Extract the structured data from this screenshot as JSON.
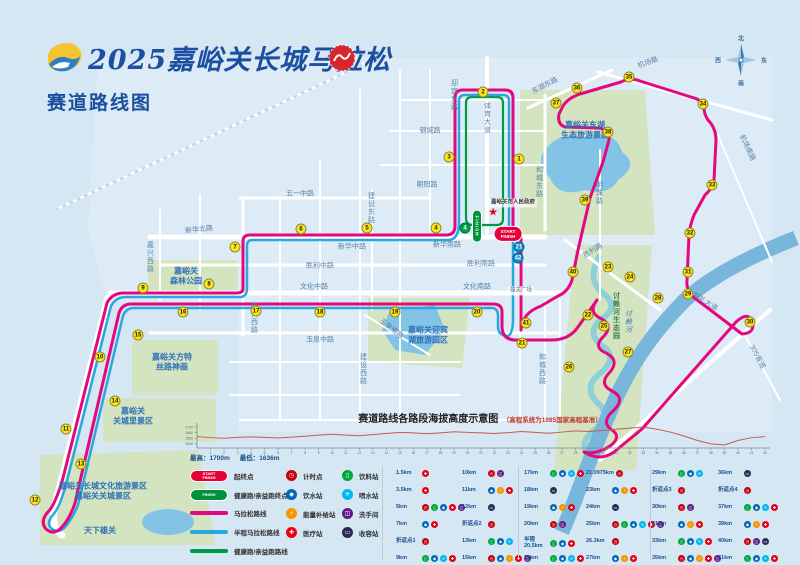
{
  "header": {
    "title": "2025嘉峪关长城马拉松",
    "subtitle": "赛道路线图",
    "icons": {
      "event_logo": "event-logo",
      "organizer_seal": "organizer-seal"
    }
  },
  "colors": {
    "marathon": "#e5077e",
    "half": "#29a8e0",
    "health": "#009a44",
    "badge_yellow": "#ffe41a",
    "start_red": "#e60039",
    "finish_green": "#00913a"
  },
  "map": {
    "compass": {
      "n": "北",
      "e": "东",
      "s": "南",
      "w": "西"
    },
    "start_badge": "START\nFINISH",
    "finish_badge": "FINISH",
    "gov_star_icon": "star-icon",
    "streets": [
      {
        "t": "机场路",
        "x": 648,
        "y": 63,
        "r": -20
      },
      {
        "t": "东湖东路",
        "x": 545,
        "y": 86,
        "r": -27
      },
      {
        "t": "机场南路",
        "x": 747,
        "y": 148,
        "r": 65
      },
      {
        "t": "体育大道",
        "x": 487,
        "y": 118,
        "v": 1
      },
      {
        "t": "迎宾东路",
        "x": 454,
        "y": 95,
        "v": 1
      },
      {
        "t": "钢城路",
        "x": 430,
        "y": 131
      },
      {
        "t": "朝阳路",
        "x": 427,
        "y": 185
      },
      {
        "t": "建设东路",
        "x": 371,
        "y": 208,
        "v": 1
      },
      {
        "t": "五一中路",
        "x": 300,
        "y": 194
      },
      {
        "t": "新华北路",
        "x": 199,
        "y": 230,
        "r": -6
      },
      {
        "t": "新华中路",
        "x": 352,
        "y": 247
      },
      {
        "t": "新华南路",
        "x": 447,
        "y": 245
      },
      {
        "t": "胜利中路",
        "x": 320,
        "y": 266
      },
      {
        "t": "胜利南路",
        "x": 481,
        "y": 264
      },
      {
        "t": "文化中路",
        "x": 314,
        "y": 287
      },
      {
        "t": "文化南路",
        "x": 477,
        "y": 287
      },
      {
        "t": "玉泉中路",
        "x": 320,
        "y": 340
      },
      {
        "t": "玉泉南路",
        "x": 391,
        "y": 329,
        "r": 38
      },
      {
        "t": "建设西路",
        "x": 363,
        "y": 369,
        "v": 1
      },
      {
        "t": "嘉兴西路",
        "x": 150,
        "y": 257,
        "v": 1
      },
      {
        "t": "雄关西路",
        "x": 254,
        "y": 318,
        "v": 1
      },
      {
        "t": "和城东路",
        "x": 539,
        "y": 182,
        "v": 1
      },
      {
        "t": "和城西路",
        "x": 542,
        "y": 369,
        "v": 1
      },
      {
        "t": "明珠路",
        "x": 599,
        "y": 193,
        "v": 1
      },
      {
        "t": "胜利路",
        "x": 593,
        "y": 251,
        "r": -33
      },
      {
        "t": "明礼大道",
        "x": 705,
        "y": 302,
        "r": 32
      },
      {
        "t": "305省道",
        "x": 757,
        "y": 357,
        "r": 62
      },
      {
        "t": "讨赖河",
        "x": 628,
        "y": 322,
        "v": 1,
        "w": 1
      }
    ],
    "landmarks": [
      {
        "t": "嘉峪关东湖\n生态旅游景区",
        "x": 585,
        "y": 131
      },
      {
        "t": "嘉峪关\n森林公园",
        "x": 186,
        "y": 277
      },
      {
        "t": "嘉峪关迎宾\n湖旅游园区",
        "x": 428,
        "y": 336
      },
      {
        "t": "嘉峪关方特\n丝路神画",
        "x": 172,
        "y": 363
      },
      {
        "t": "嘉峪关\n关城里景区",
        "x": 133,
        "y": 417
      },
      {
        "t": "嘉峪关长城文化旅游景区\n嘉峪关关城景区",
        "x": 103,
        "y": 492
      },
      {
        "t": "天下雄关",
        "x": 100,
        "y": 531
      },
      {
        "t": "讨赖河生态园",
        "x": 616,
        "y": 316,
        "k": "green"
      },
      {
        "t": "雄关广场",
        "x": 521,
        "y": 291,
        "k": "box"
      },
      {
        "t": "嘉峪关市人民政府",
        "x": 513,
        "y": 203,
        "k": "gov"
      }
    ],
    "km_markers": [
      [
        1,
        519,
        159,
        "y"
      ],
      [
        2,
        483,
        92,
        "y"
      ],
      [
        3,
        449,
        157,
        "y"
      ],
      [
        4,
        436,
        228,
        "y"
      ],
      [
        5,
        367,
        228,
        "y"
      ],
      [
        6,
        301,
        229,
        "y"
      ],
      [
        7,
        235,
        247,
        "y"
      ],
      [
        8,
        209,
        284,
        "y"
      ],
      [
        9,
        143,
        288,
        "y"
      ],
      [
        10,
        100,
        357,
        "y"
      ],
      [
        11,
        66,
        429,
        "y"
      ],
      [
        12,
        35,
        500,
        "y"
      ],
      [
        13,
        81,
        464,
        "y"
      ],
      [
        14,
        115,
        401,
        "y"
      ],
      [
        15,
        138,
        335,
        "y"
      ],
      [
        16,
        183,
        312,
        "y"
      ],
      [
        17,
        256,
        311,
        "y"
      ],
      [
        18,
        320,
        312,
        "y"
      ],
      [
        19,
        395,
        312,
        "y"
      ],
      [
        20,
        477,
        312,
        "y"
      ],
      [
        21,
        522,
        343,
        "y"
      ],
      [
        22,
        588,
        315,
        "y"
      ],
      [
        23,
        608,
        267,
        "y"
      ],
      [
        24,
        630,
        277,
        "y"
      ],
      [
        25,
        604,
        326,
        "y"
      ],
      [
        26,
        569,
        367,
        "y"
      ],
      [
        27,
        628,
        352,
        "y"
      ],
      [
        28,
        658,
        298,
        "y"
      ],
      [
        29,
        688,
        294,
        "y"
      ],
      [
        30,
        750,
        322,
        "y"
      ],
      [
        31,
        688,
        272,
        "y"
      ],
      [
        32,
        690,
        233,
        "y"
      ],
      [
        33,
        712,
        185,
        "y"
      ],
      [
        34,
        703,
        104,
        "y"
      ],
      [
        35,
        629,
        77,
        "y"
      ],
      [
        36,
        577,
        88,
        "y"
      ],
      [
        37,
        556,
        103,
        "y"
      ],
      [
        38,
        608,
        132,
        "y"
      ],
      [
        39,
        585,
        200,
        "y"
      ],
      [
        40,
        573,
        272,
        "y"
      ],
      [
        41,
        526,
        323,
        "y"
      ],
      [
        21,
        519,
        247,
        "b"
      ],
      [
        42,
        518,
        258,
        "b"
      ],
      [
        4,
        465,
        228,
        "g"
      ]
    ]
  },
  "elevation": {
    "title": "赛道路线各路段海拔高度示意图",
    "title_note": "（高程系统为1985国家高程基准）",
    "max_label": "最高：1700m",
    "min_label": "最低：1636m"
  },
  "chart_data": {
    "type": "line",
    "title": "赛道路线各路段海拔高度示意图",
    "xlabel": "km",
    "ylabel": "海拔(m)",
    "x_ticks": [
      1,
      2,
      3,
      4,
      5,
      6,
      7,
      8,
      9,
      10,
      11,
      12,
      13,
      14,
      15,
      16,
      17,
      18,
      19,
      20,
      21,
      22,
      23,
      24,
      25,
      26,
      27,
      28,
      29,
      30,
      31,
      32,
      33,
      34,
      35,
      36,
      37,
      38,
      39,
      40,
      41,
      42
    ],
    "y_ticks": [
      1640,
      1660,
      1680,
      1700
    ],
    "ylim": [
      1630,
      1710
    ],
    "x": [
      0,
      1,
      2,
      3,
      4,
      5,
      6,
      7,
      8,
      9,
      10,
      11,
      12,
      13,
      14,
      15,
      16,
      17,
      18,
      19,
      20,
      21,
      22,
      23,
      24,
      25,
      26,
      27,
      28,
      29,
      30,
      31,
      32,
      33,
      34,
      35,
      36,
      37,
      38,
      39,
      40,
      41,
      42
    ],
    "values": [
      1666,
      1662,
      1660,
      1663,
      1665,
      1663,
      1661,
      1664,
      1667,
      1671,
      1674,
      1671,
      1669,
      1673,
      1677,
      1681,
      1679,
      1676,
      1679,
      1683,
      1681,
      1679,
      1677,
      1680,
      1684,
      1681,
      1678,
      1682,
      1686,
      1684,
      1688,
      1692,
      1696,
      1700,
      1692,
      1682,
      1668,
      1652,
      1640,
      1636,
      1652,
      1662,
      1666
    ],
    "max": 1700,
    "min": 1636,
    "line_color": "#c85a50"
  },
  "legend": {
    "route_items": [
      {
        "kind": "pill-red",
        "badge": "START\nFINISH",
        "label": "起终点"
      },
      {
        "kind": "pill-grn",
        "badge": "FINISH",
        "label": "健康跑/亲益跑终点"
      },
      {
        "kind": "line",
        "color": "#e5077e",
        "label": "马拉松路线"
      },
      {
        "kind": "line",
        "color": "#29a8e0",
        "label": "半程马拉松路线"
      },
      {
        "kind": "line",
        "color": "#009a44",
        "label": "健康跑/亲益跑路线"
      }
    ],
    "station_types": {
      "timing": {
        "label": "计时点",
        "color": "#c7000b",
        "glyph": "◷"
      },
      "water": {
        "label": "饮水站",
        "color": "#0068b7",
        "glyph": "◆"
      },
      "energy": {
        "label": "能量补给站",
        "color": "#f39800",
        "glyph": "⚡"
      },
      "medical": {
        "label": "医疗站",
        "color": "#e60012",
        "glyph": "✚"
      },
      "drink": {
        "label": "饮料站",
        "color": "#00a73c",
        "glyph": "▯"
      },
      "spray": {
        "label": "喷水站",
        "color": "#00b7ee",
        "glyph": "✳"
      },
      "toilet": {
        "label": "洗手间",
        "color": "#601986",
        "glyph": "◫"
      },
      "sweep": {
        "label": "收容站",
        "color": "#2a2a5a",
        "glyph": "▭"
      }
    },
    "station_col_a": [
      "timing",
      "water",
      "energy",
      "medical"
    ],
    "station_col_b": [
      "drink",
      "spray",
      "toilet",
      "sweep"
    ]
  },
  "km_table": {
    "columns": [
      [
        {
          "km": "1.5km",
          "s": [
            "medical"
          ]
        },
        {
          "km": "3.5km",
          "s": [
            "medical"
          ]
        },
        {
          "km": "5km",
          "s": [
            "timing",
            "drink",
            "water",
            "medical",
            "toilet"
          ]
        },
        {
          "km": "7km",
          "s": [
            "water",
            "medical"
          ]
        },
        {
          "km": "折返点1",
          "s": [
            "timing"
          ]
        },
        {
          "km": "9km",
          "s": [
            "drink",
            "water",
            "spray",
            "medical"
          ]
        }
      ],
      [
        {
          "km": "10km",
          "s": [
            "timing",
            "toilet"
          ]
        },
        {
          "km": "11km",
          "s": [
            "water",
            "energy",
            "medical"
          ]
        },
        {
          "km": "12km",
          "s": [
            "sweep"
          ]
        },
        {
          "km": "折返点2",
          "s": [
            "timing"
          ]
        },
        {
          "km": "13km",
          "s": [
            "drink",
            "water",
            "spray"
          ]
        },
        {
          "km": "15km",
          "s": [
            "timing",
            "water",
            "energy",
            "medical",
            "toilet"
          ]
        }
      ],
      [
        {
          "km": "17km",
          "s": [
            "drink",
            "water",
            "spray",
            "medical"
          ]
        },
        {
          "km": "18km",
          "s": [
            "sweep"
          ]
        },
        {
          "km": "19km",
          "s": [
            "water",
            "energy",
            "medical"
          ]
        },
        {
          "km": "20km",
          "s": [
            "timing",
            "toilet"
          ]
        },
        {
          "km": "半程\n20.5km",
          "s": [
            "drink",
            "water",
            "medical"
          ]
        },
        {
          "km": "21km",
          "s": [
            "drink",
            "water",
            "spray",
            "medical"
          ]
        }
      ],
      [
        {
          "km": "21.0975km",
          "s": [
            "timing"
          ]
        },
        {
          "km": "23km",
          "s": [
            "water",
            "energy",
            "medical"
          ]
        },
        {
          "km": "24km",
          "s": [
            "sweep"
          ]
        },
        {
          "km": "25km",
          "s": [
            "timing",
            "drink",
            "water",
            "spray",
            "medical",
            "toilet"
          ]
        },
        {
          "km": "26.3km",
          "s": [
            "timing"
          ]
        },
        {
          "km": "27km",
          "s": [
            "water",
            "energy",
            "medical"
          ]
        }
      ],
      [
        {
          "km": "29km",
          "s": [
            "drink",
            "water",
            "spray"
          ]
        },
        {
          "km": "折返点3",
          "s": [
            "timing"
          ]
        },
        {
          "km": "30km",
          "s": [
            "timing",
            "toilet"
          ]
        },
        {
          "km": "31km",
          "s": [
            "water",
            "energy",
            "medical"
          ]
        },
        {
          "km": "33km",
          "s": [
            "drink",
            "water",
            "spray",
            "medical"
          ]
        },
        {
          "km": "35km",
          "s": [
            "timing",
            "water",
            "energy",
            "medical",
            "toilet"
          ]
        }
      ],
      [
        {
          "km": "36km",
          "s": [
            "sweep"
          ]
        },
        {
          "km": "折返点4",
          "s": [
            "timing"
          ]
        },
        {
          "km": "37km",
          "s": [
            "drink",
            "water",
            "spray",
            "medical"
          ]
        },
        {
          "km": "39km",
          "s": [
            "water",
            "energy",
            "medical"
          ]
        },
        {
          "km": "40km",
          "s": [
            "timing",
            "toilet",
            "sweep"
          ]
        },
        {
          "km": "41km",
          "s": [
            "drink",
            "water",
            "spray",
            "medical"
          ]
        }
      ]
    ]
  }
}
